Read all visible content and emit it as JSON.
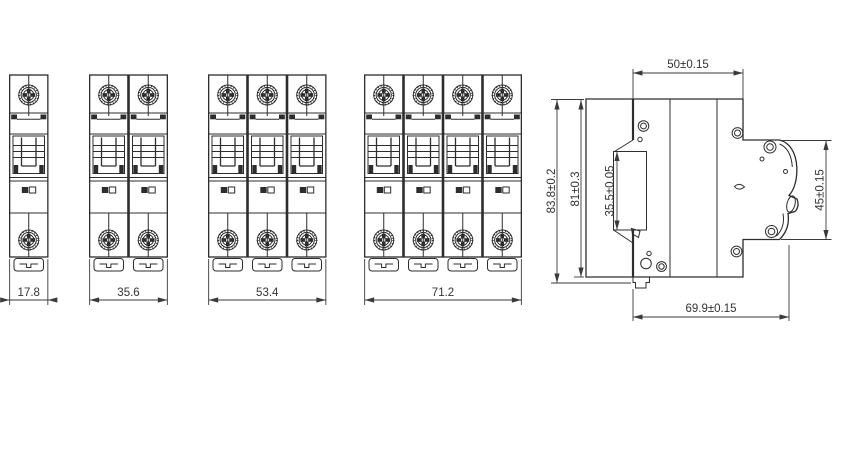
{
  "drawing": {
    "line_color": "#2d2d2d",
    "dim_color": "#3a3a3a",
    "background": "#ffffff",
    "front_views": [
      {
        "poles": 1,
        "label": "17.8"
      },
      {
        "poles": 2,
        "label": "35.6"
      },
      {
        "poles": 3,
        "label": "53.4"
      },
      {
        "poles": 4,
        "label": "71.2"
      }
    ],
    "side_view": {
      "width_top": "50±0.15",
      "height_overall": "83.8±0.2",
      "height_body": "81±0.3",
      "height_din_slot": "35.5±0.05",
      "height_front": "45±0.15",
      "depth_overall": "69.9±0.15"
    }
  }
}
